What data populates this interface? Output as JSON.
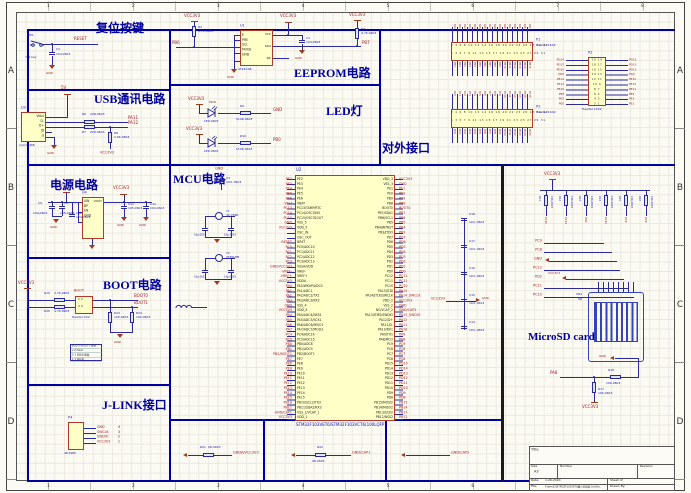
{
  "frame": {
    "zones_top": [
      "1",
      "2",
      "3",
      "4",
      "5",
      "6",
      "7",
      "8"
    ],
    "zones_side": [
      "A",
      "B",
      "C",
      "D"
    ]
  },
  "reset": {
    "title": "复位按键",
    "sw_ref": "SW1",
    "sw_val": "7*4 key",
    "c_ref": "C2",
    "c_val": "104,0603",
    "net": "RESET",
    "gnd": "GND"
  },
  "usb": {
    "title": "USB通讯电路",
    "u_ref": "U3",
    "u_type": "micro USB",
    "pins": [
      "Vbus",
      "D-",
      "D+",
      "ID",
      "G"
    ],
    "pwr": "5V",
    "r6_ref": "R6",
    "r6_val": "22R,0603",
    "r7_ref": "R7",
    "r7_val": "22R,0603",
    "r8_ref": "R8",
    "r8_val": "1.5K,0603",
    "net_a": "PA11",
    "net_b": "PA12",
    "vcc": "VCC3V3",
    "gnd": "GND"
  },
  "power": {
    "title": "电源电路",
    "u_ref": "U4",
    "pins_left": [
      "VIN",
      "BP",
      "EN",
      "GND"
    ],
    "pin_right": "VOUT",
    "pwr_in": "5V",
    "pwr_out": "VCC3V3",
    "c9_ref": "C9",
    "c9_val": "104,0603",
    "c8_ref": "C8",
    "c8_val": "105,0603",
    "c10_ref": "C10",
    "c10_val": "104,0603",
    "c11_ref": "C11",
    "c11_val": "105,0603",
    "c12_ref": "C12",
    "c12_val": "104,0603",
    "gnd": "GND"
  },
  "boot": {
    "title": "BOOT电路",
    "vcc": "VCC3V3",
    "r19_ref": "R19",
    "r19_val": "4.7K,0603",
    "r20_ref": "R20",
    "r20_val": "4.7K,0603",
    "hdr_name": "BOOT",
    "hdr_row1": "1    2",
    "hdr_row2": "3    4",
    "hdr_type": "Header 2X2",
    "net0": "BOOT0",
    "net1": "BOOT1",
    "r23_ref": "R23",
    "r23_val": "10K,0603",
    "r24_ref": "R24",
    "r24_val": "10K,0603",
    "table_rows": [
      "BOOT0 BOOT1 模式",
      "x  0  Flash",
      "0  1  系统存储器",
      "1  1  SRAM"
    ],
    "gnd": "GND"
  },
  "jlink": {
    "title": "J-LINK接口",
    "p_ref": "P4",
    "pins": [
      "4",
      "3",
      "2",
      "1"
    ],
    "nets": [
      "GND",
      "SWCLK",
      "SWDIO",
      "VCC3V3"
    ],
    "p_type": "4P,SWD"
  },
  "eeprom": {
    "title": "EEPROM电路",
    "u_ref": "U1",
    "u_part": "AT24C08",
    "pins_left": [
      "E",
      "PRE",
      "SCL",
      "MODE",
      "GND"
    ],
    "pins_right": [
      "VCC",
      "SDA",
      "NC"
    ],
    "r2_ref": "R2",
    "r2_val": "4.7K,0603",
    "r3_ref": "R3",
    "r3_val": "4.7K,0603",
    "c1_ref": "C1",
    "c1_val": "104,0603",
    "net_a": "PB6",
    "net_b": "PB7",
    "vcc": "VCC3V3",
    "gnd": "GND"
  },
  "led": {
    "title": "LED灯",
    "d1_name": "PWR",
    "d_val": "LED,0603",
    "r9_ref": "R9",
    "r9_val": "510R,0603",
    "r10_ref": "R10",
    "r10_val": "510R,0603",
    "net_r1": "GND",
    "net_r2": "PB0",
    "vcc": "VCC3V3"
  },
  "mcu": {
    "title": "MCU电路",
    "ref": "U2",
    "part": "STM32F103VET6/STM32F103VCT6(100LQFP)",
    "left_pins": [
      "PE2",
      "PE3",
      "PE4",
      "PE5",
      "PE6",
      "VBAT",
      "PC13/TAMP/RTC",
      "PC14/OSC32IN",
      "PC15/OSC32OUT",
      "VSS_5",
      "VDD_5",
      "OSC_IN",
      "OSC_OUT",
      "NRST",
      "PC0/ADC10",
      "PC1/ADC11",
      "PC2/ADC12",
      "PC3/ADC13",
      "VSSA/VDD",
      "VREF-",
      "VREF+",
      "VDDA",
      "PA0/WKUP/ADC0",
      "PA1/ADC1",
      "PA2/ADC2/TX2",
      "PA3/ADC3/RX2",
      "VSS_4",
      "VDD_4",
      "PA4/ADC4/NSS1",
      "PA5/ADC5/SCK1",
      "PA6/ADC6/MISO1",
      "PA7/ADC7/MOSI1",
      "PC4/ADC14",
      "PC5/ADC15",
      "PB0/ADC8",
      "PB1/ADC9",
      "PB2/BOOT1",
      "PE7",
      "PE8",
      "PE9",
      "PE10",
      "PE11",
      "PE12",
      "PE13",
      "PE14",
      "PE15",
      "PB10/SCL2/TX3",
      "PB11/SDA2/RX3",
      "VSS_1/VCAP_1",
      "VDD_1"
    ],
    "right_pins": [
      "VDD_3",
      "VSS_3",
      "PE1",
      "PE0",
      "PB9",
      "PB8",
      "BOOT0",
      "PB7/SDA1",
      "PB6/SCL1",
      "PB5",
      "PB4/JNTRST",
      "PB3/JTDO",
      "PD7",
      "PD6",
      "PD5",
      "PD4",
      "PD3",
      "PD2",
      "PD1",
      "PD0",
      "PC12",
      "PC11",
      "PC10",
      "PA15/JTDI",
      "PA14/JTCK/SWCLK",
      "VDD_2",
      "VSS_2",
      "NC/VCAP_2",
      "PA13/JTMS/SWDIO",
      "PA12/D+",
      "PA11/D-",
      "PA10/RX1",
      "PA9/TX1",
      "PA8/MCO",
      "PC9",
      "PC8",
      "PC7",
      "PC6",
      "PD15",
      "PD14",
      "PD13",
      "PD12",
      "PD11",
      "PD10",
      "PD9",
      "PD8",
      "PB15/MOSI2",
      "PB14/MISO2",
      "PB13/SCK2",
      "PB12/NSS2"
    ],
    "left_nets": [
      "PE2",
      "PE3",
      "PE4",
      "PE5",
      "PE6",
      "Vbat",
      "PC13",
      "PC14",
      "PC15",
      "GND",
      "VCC3V3",
      "",
      "",
      "RESET",
      "PC0",
      "PC1",
      "PC2",
      "PC3",
      "GND/VCC3V3",
      "VREF-",
      "VREF+",
      "VCC3V3",
      "PA0",
      "PA1",
      "PA2",
      "PA3",
      "GND",
      "VCC3V3",
      "PA4",
      "PA5",
      "PA6",
      "PA7",
      "PC4",
      "PC5",
      "PB0",
      "PB1",
      "PB2/BOOT1",
      "PE7",
      "PE8",
      "PE9",
      "PE10",
      "PE11",
      "PE12",
      "PE13",
      "PE14",
      "PE15",
      "PB10",
      "PB11",
      "GND/CAP1",
      "VCC3V3"
    ],
    "right_nets": [
      "VCC3V3",
      "GND",
      "PE1",
      "PE0",
      "PB9",
      "PB8",
      "BOOT0",
      "PB7",
      "PB6",
      "PB5",
      "PB4",
      "PB3",
      "PD7",
      "PD6",
      "PD5",
      "PD4",
      "PD3",
      "PD2",
      "PD1",
      "PD0",
      "PC12",
      "PC11",
      "PC10",
      "PA15",
      "PA14_SWCLK",
      "VCC3V3",
      "GND",
      "GND/CAP2",
      "PA13_SWDIO",
      "PA12",
      "PA11",
      "PA10",
      "PA9",
      "PA8",
      "PC9",
      "PC8",
      "PC7",
      "PC6",
      "PD15",
      "PD14",
      "PD13",
      "PD12",
      "PD11",
      "PD10",
      "PD9",
      "PD8",
      "PB15",
      "PB14",
      "PB13",
      "PB12"
    ],
    "c3_ref": "C3",
    "c3_val": "104, 0603",
    "y1_ref": "Y1",
    "y1_val": "32.768K",
    "y2_ref": "Y2",
    "y2_val": "25M&8M",
    "cap_small_val": "10p,0603",
    "chain_refs": [
      "C18",
      "C17",
      "C16",
      "C15",
      "C14"
    ],
    "chain_val": "104, 0603",
    "vcc": "VCC3V3",
    "gnd": "GND"
  },
  "ext": {
    "title": "对外接口",
    "p1_ref": "P1",
    "p1_type": "Header 16X2",
    "p3_ref": "P3",
    "p3_type": "Header 16X2",
    "p2_ref": "P2",
    "p2_type": "Header 10X2",
    "p1_row_top": "2 4 6 8 10 12 14 16 18 20 22 24 26 28 30 32",
    "p1_row_bot": "1 3 5 7 9 11 13 15 17 19 21 23 25 27 29 31",
    "p3_row_top": "2 4 6 8 10 12 14 16 18 20 22 24 26 28 30 32",
    "p3_row_bot": "1 3 5 7 9 11 13 15 17 19 21 23 25 27 29 31",
    "p1_top": [
      "PA0",
      "PA1",
      "PA2",
      "PA3",
      "PA4",
      "PA5",
      "PA6",
      "PA7",
      "PA8",
      "PA9",
      "PA10",
      "PA11",
      "PA12",
      "PA13",
      "PA14",
      "PA15"
    ],
    "p1_bot": [
      "PB0",
      "PB1",
      "PB2",
      "PB3",
      "PB4",
      "PB5",
      "PB6",
      "PB7",
      "PB8",
      "PB9",
      "PB10",
      "PB11",
      "PB12",
      "PB13",
      "PB14",
      "PB15"
    ],
    "p3_top": [
      "PC0",
      "PC1",
      "PC2",
      "PC3",
      "PC4",
      "PC5",
      "PC6",
      "PC7",
      "PC8",
      "PC9",
      "PC10",
      "PC11",
      "PC12",
      "PC13",
      "PC14",
      "PC15"
    ],
    "p3_bot": [
      "PD0",
      "PD1",
      "PD2",
      "PD3",
      "PD4",
      "PD5",
      "PD6",
      "PD7",
      "PD8",
      "PD9",
      "PD10",
      "PD11",
      "PD12",
      "PD13",
      "PD14",
      "PD15"
    ],
    "p2_rows": [
      "20 19",
      "18 17",
      "16 15",
      "14 13",
      "12 11",
      "10 9",
      "8 7",
      "6 5",
      "4 3",
      "2 1"
    ],
    "p2_left": [
      "PD14",
      "PD12",
      "PD10",
      "PD8",
      "PE14",
      "PE12",
      "PE10",
      "PE8",
      "PE2",
      "PE0"
    ],
    "p2_right": [
      "PD15",
      "PD13",
      "PD11",
      "PD9",
      "PE15",
      "PE13",
      "PE11",
      "PE9",
      "PE3",
      "PE1"
    ]
  },
  "sd": {
    "title": "MicroSD card",
    "vcc": "VCC3V3",
    "gnd": "GND",
    "pullup_refs": [
      "R11",
      "R12",
      "R13",
      "R14",
      "R15",
      "R16"
    ],
    "pullup_val": "10K,0603",
    "pullup_nets": [
      "PC10",
      "PC11",
      "PD2",
      "PC12",
      "PC8",
      "PC9"
    ],
    "stub_nets": [
      "PC9",
      "PC8",
      "GND",
      "PC12",
      "PD2",
      "PC11",
      "PC10"
    ],
    "cn_ref": "CN1",
    "cn_val": "SD",
    "r18_ref": "R18",
    "r18_val": "10K,0603",
    "r17_ref": "R17",
    "r17_val": "10K,0603",
    "net_pa8": "PA8"
  },
  "bottom": {
    "r21_ref": "R21",
    "r21_val": "0R,0603",
    "net1": "GNDA/VCC3V3",
    "r22_ref": "R22",
    "r22_val": "0R,0603",
    "net2": "GND/CAP1",
    "net3": "GND/CAP2"
  },
  "titleblock": {
    "title_label": "Title",
    "size_label": "Size",
    "size": "A3",
    "number_label": "Number",
    "revision_label": "Revision",
    "date_label": "Date:",
    "date": "1-26-2020",
    "sheet_label": "Sheet   of",
    "file_label": "File:",
    "file": "F:\\stm32\\STM32F103VET6最小系统板.SchDoc",
    "drawn_label": "Drawn By:"
  }
}
